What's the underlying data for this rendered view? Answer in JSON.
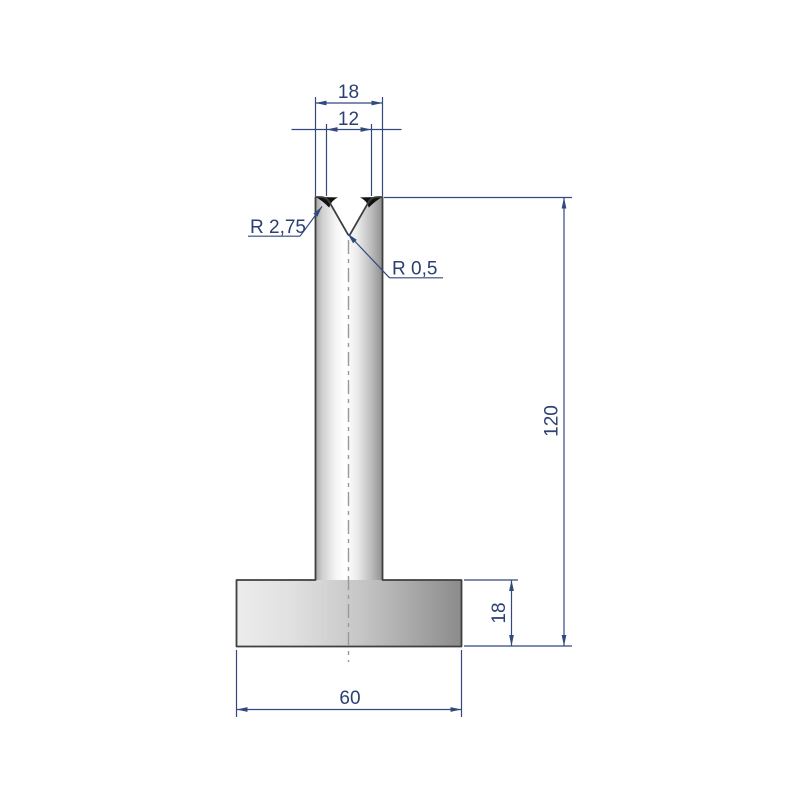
{
  "dims": {
    "top_width": "18",
    "v_opening": "12",
    "total_height": "120",
    "base_height": "18",
    "base_width": "60"
  },
  "radius_labels": {
    "shoulder": "R 2,75",
    "vertex": "R 0,5"
  },
  "colors": {
    "dimension_blue": "#31497e",
    "text_blue": "#2c3f72",
    "outline_gray": "#3f3f3f",
    "centerline_gray": "#9a9a9a",
    "shoulder_fill": "#111111"
  }
}
